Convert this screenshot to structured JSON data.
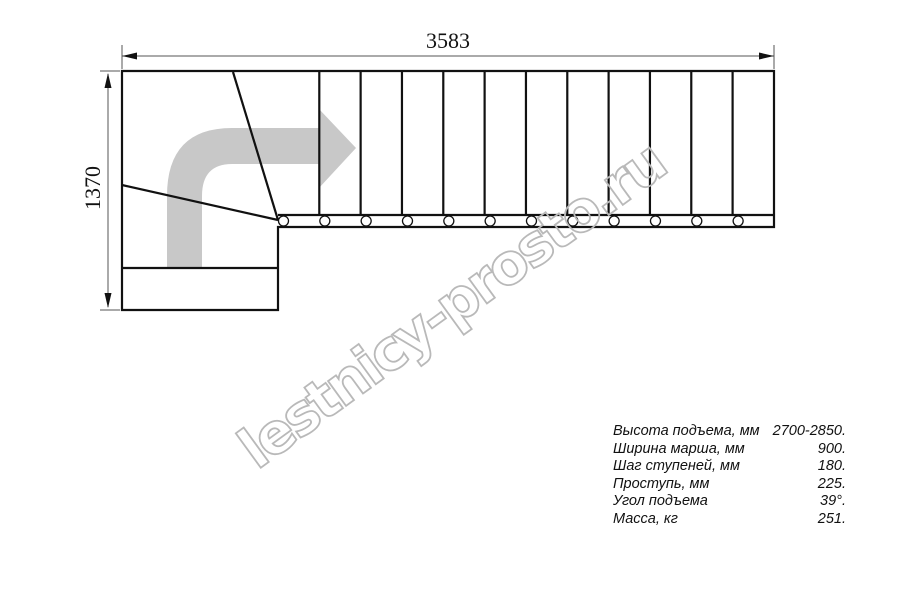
{
  "dimensions": {
    "width_label": "3583",
    "height_label": "1370"
  },
  "watermark": {
    "text": "lestnicy-prosto.ru"
  },
  "specs": {
    "rows": [
      {
        "label": "Высота подъема, мм",
        "value": "2700-2850."
      },
      {
        "label": "Ширина марша, мм",
        "value": "900."
      },
      {
        "label": "Шаг ступеней, мм",
        "value": "180."
      },
      {
        "label": "Проступь, мм",
        "value": "225."
      },
      {
        "label": "Угол подъема",
        "value": "39°."
      },
      {
        "label": "Масса, кг",
        "value": "251."
      }
    ]
  },
  "plan": {
    "tread_count": 12,
    "riser_count": 11,
    "riser_start_x": 319.3,
    "riser_spacing": 41.33,
    "riser_top_y": 72,
    "riser_bottom_y": 215,
    "bolt_count": 12,
    "bolt_start_x": 283.5,
    "bolt_spacing": 41.33,
    "bolt_y": 221,
    "bolt_radius": 5
  },
  "colors": {
    "line": "#111111",
    "dim_line": "#555555",
    "arrow_fill": "#c8c8c8",
    "watermark": "#b9b9b9",
    "text": "#111111",
    "background": "#ffffff"
  }
}
